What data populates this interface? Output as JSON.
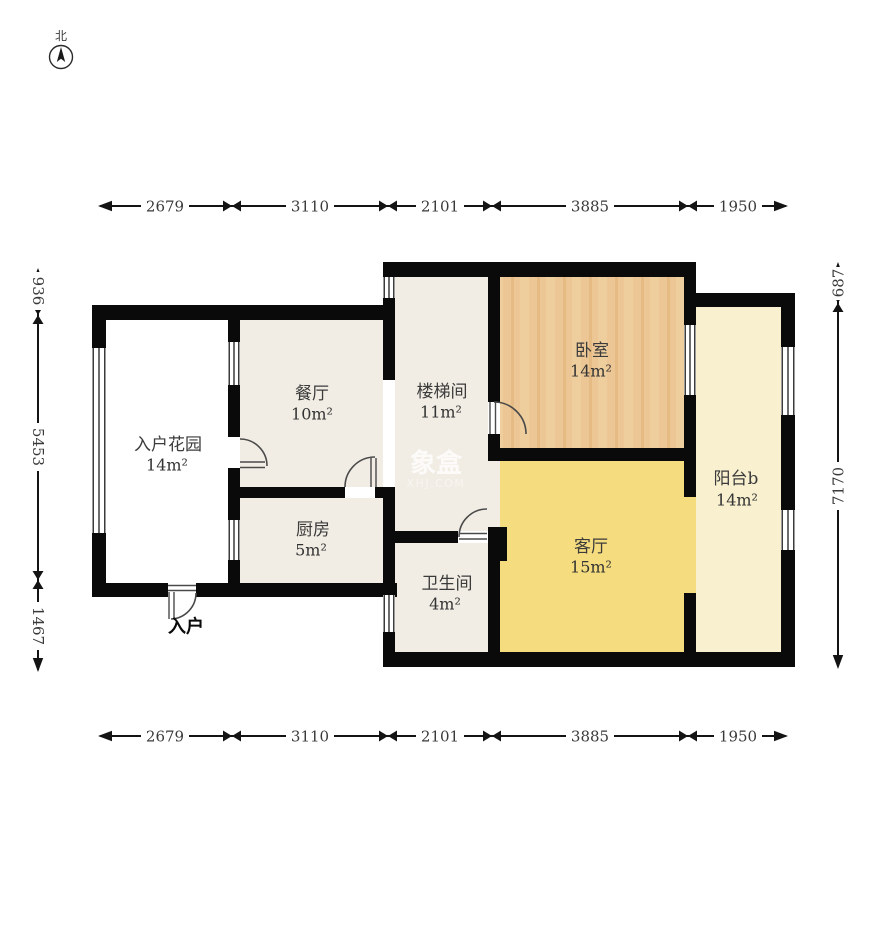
{
  "compass": {
    "label": "北"
  },
  "watermark": {
    "brand": "象盒",
    "site": "XHJ.COM"
  },
  "entry_label": "入户",
  "rooms": {
    "garden": {
      "name": "入户花园",
      "area": "14m²"
    },
    "dining": {
      "name": "餐厅",
      "area": "10m²"
    },
    "kitchen": {
      "name": "厨房",
      "area": "5m²"
    },
    "stairwell": {
      "name": "楼梯间",
      "area": "11m²"
    },
    "bedroom": {
      "name": "卧室",
      "area": "14m²"
    },
    "living": {
      "name": "客厅",
      "area": "15m²"
    },
    "bathroom": {
      "name": "卫生间",
      "area": "4m²"
    },
    "balcony": {
      "name": "阳台b",
      "area": "14m²"
    }
  },
  "dimensions": {
    "top": [
      "2679",
      "3110",
      "2101",
      "3885",
      "1950"
    ],
    "bottom": [
      "2679",
      "3110",
      "2101",
      "3885",
      "1950"
    ],
    "left": [
      "936",
      "5453",
      "1467"
    ],
    "right": [
      "687",
      "7170"
    ]
  },
  "colors": {
    "wall": "#0a0a0a",
    "garden_floor": "#ffffff",
    "neutral_floor": "#f1ede4",
    "bedroom_floor": "#ecc795",
    "bedroom_grain_light": "#f2d2a3",
    "bedroom_grain_dark": "#deae72",
    "living_floor": "#f5dc7f",
    "balcony_floor": "#f8f0cf"
  }
}
